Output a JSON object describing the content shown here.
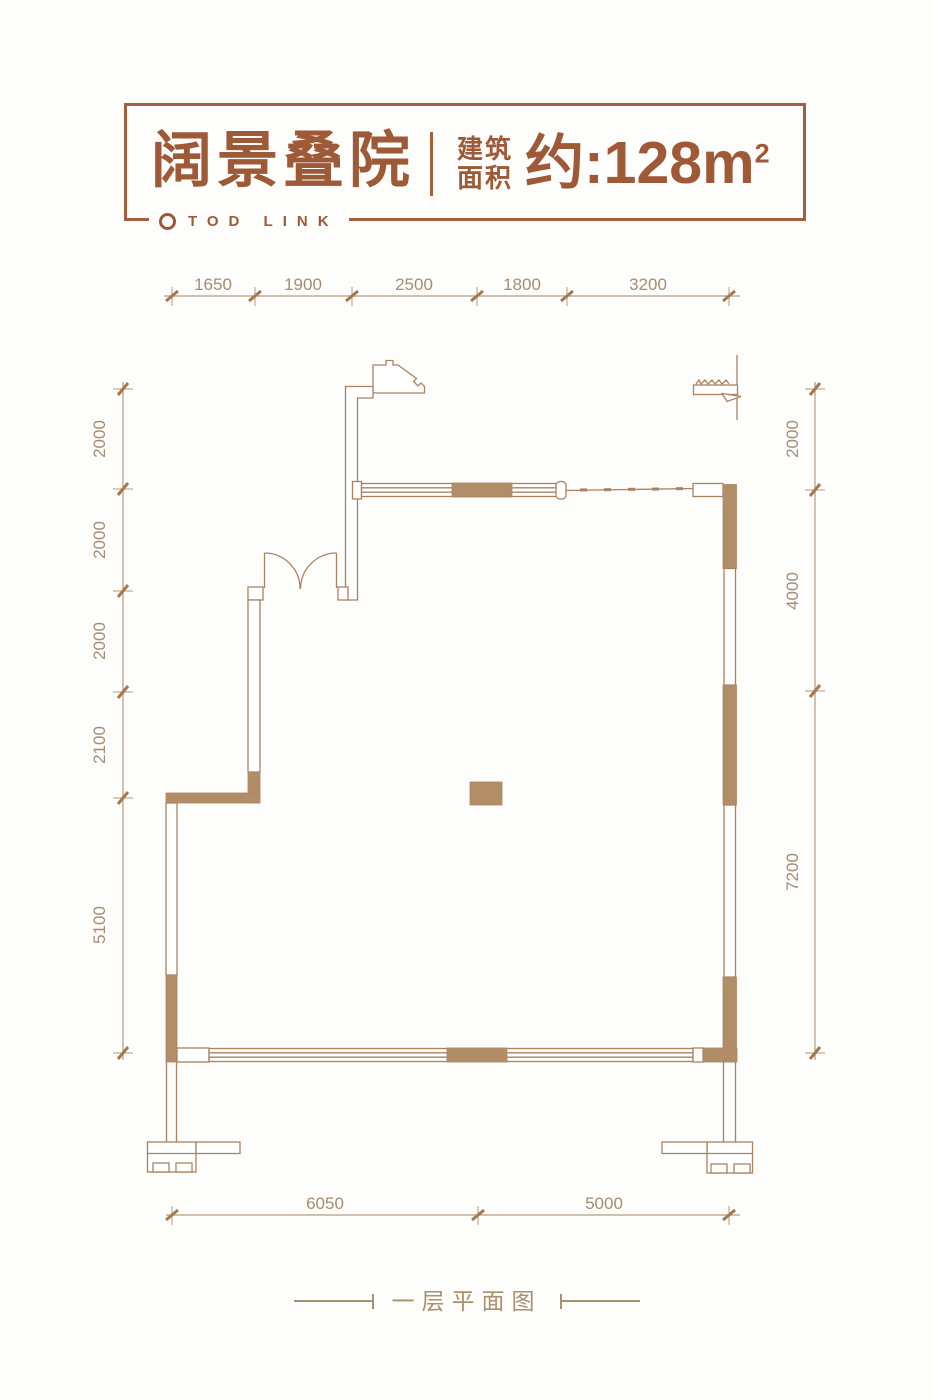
{
  "header": {
    "title": "阔景叠院",
    "logo_text": "TOD LINK",
    "area_label_line1": "建筑",
    "area_label_line2": "面积",
    "area_text": "约:128m",
    "area_superscript": "2"
  },
  "dimensions": {
    "top": [
      "1650",
      "1900",
      "2500",
      "1800",
      "3200"
    ],
    "left": [
      "2000",
      "2000",
      "2000",
      "2100",
      "5100"
    ],
    "right": [
      "2000",
      "4000",
      "7200"
    ],
    "bottom": [
      "6050",
      "5000"
    ]
  },
  "caption": "一层平面图",
  "colors": {
    "accent_brown": "#9e5937",
    "border_brown": "#a2603e",
    "wall_fill": "#b28e68",
    "wall_line": "#ab8260",
    "dim_text": "#a58c72",
    "background": "#fdfdfc"
  }
}
